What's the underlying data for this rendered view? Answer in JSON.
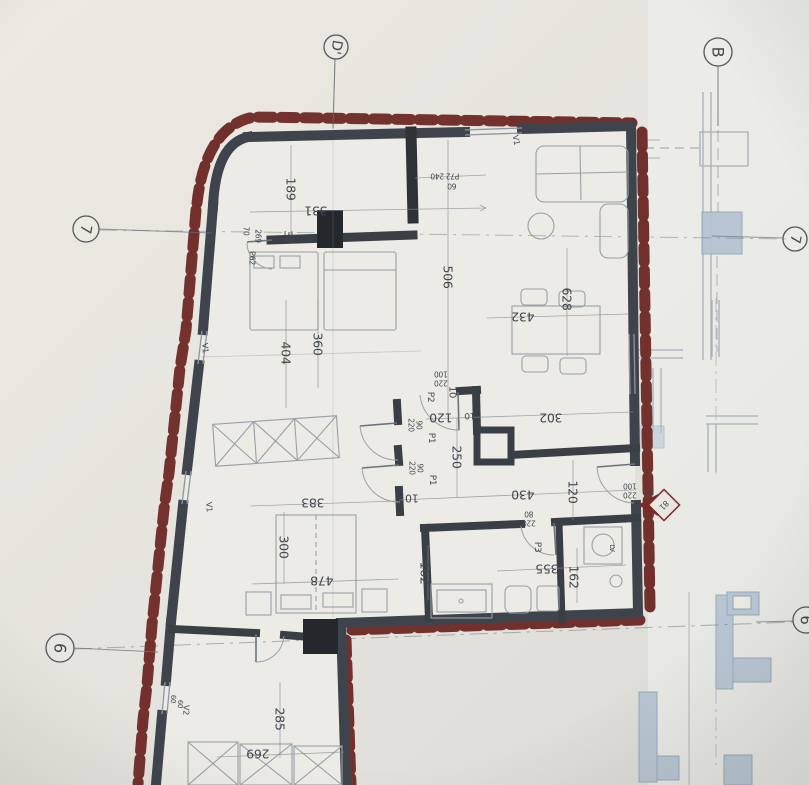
{
  "sheet": {
    "description_labels_note": "architectural floor plan photo",
    "colors": {
      "paper": "#e9e7e1",
      "insulation_red": "#6e2b27",
      "wall_dark": "#3f444c",
      "wall_black": "#24282d",
      "label_ink": "#43474d",
      "adjacent_blue": "#b3c3d2",
      "entry_marker_red": "#7c2a24"
    }
  },
  "grid_markers": [
    {
      "label": "D'",
      "cx": 336,
      "cy": 47,
      "r": 12,
      "rot": 100,
      "leader": "M335,59 L333,128"
    },
    {
      "label": "B",
      "cx": 718,
      "cy": 52,
      "r": 14,
      "rot": 90,
      "leader": "M718,66 L718,126"
    },
    {
      "label": "7",
      "cx": 86,
      "cy": 229,
      "r": 13,
      "rot": 100,
      "leader": "M99,229 L212,233"
    },
    {
      "label": "7",
      "cx": 795,
      "cy": 239,
      "r": 12,
      "rot": 100,
      "leader": "M712,236 L783,238"
    },
    {
      "label": "6",
      "cx": 60,
      "cy": 648,
      "r": 14,
      "rot": 95,
      "leader": "M74,648 L158,652"
    },
    {
      "label": "6",
      "cx": 806,
      "cy": 620,
      "r": 13,
      "rot": 95,
      "leader": "M756,622 L793,621"
    }
  ],
  "labels": [
    {
      "text": "189",
      "x": 291,
      "y": 189,
      "rot": 90,
      "size": 12.5
    },
    {
      "text": "331",
      "x": 316,
      "y": 211,
      "rot": 180,
      "size": 12.5
    },
    {
      "text": "37",
      "x": 288,
      "y": 237,
      "rot": 90,
      "size": 11
    },
    {
      "text": "P62",
      "x": 252,
      "y": 258,
      "rot": 90,
      "size": 8
    },
    {
      "text": "70",
      "x": 246,
      "y": 231,
      "rot": 90,
      "size": 7.5
    },
    {
      "text": "269",
      "x": 258,
      "y": 236,
      "rot": 90,
      "size": 7.5
    },
    {
      "text": "P72 240",
      "x": 445,
      "y": 176,
      "rot": 180,
      "size": 7.5
    },
    {
      "text": "60",
      "x": 452,
      "y": 186,
      "rot": 180,
      "size": 7.5
    },
    {
      "text": "V1",
      "x": 516,
      "y": 140,
      "rot": 80,
      "size": 8
    },
    {
      "text": "506",
      "x": 448,
      "y": 277,
      "rot": 90,
      "size": 12.5
    },
    {
      "text": "628",
      "x": 567,
      "y": 299,
      "rot": 90,
      "size": 12.5
    },
    {
      "text": "432",
      "x": 523,
      "y": 317,
      "rot": 180,
      "size": 12.5
    },
    {
      "text": "404",
      "x": 286,
      "y": 353,
      "rot": 90,
      "size": 12.5
    },
    {
      "text": "360",
      "x": 318,
      "y": 344,
      "rot": 90,
      "size": 12.5
    },
    {
      "text": "V1",
      "x": 205,
      "y": 348,
      "rot": 85,
      "size": 8
    },
    {
      "text": "100",
      "x": 441,
      "y": 374,
      "rot": 180,
      "size": 7.5
    },
    {
      "text": "220",
      "x": 441,
      "y": 383,
      "rot": 180,
      "size": 7.5
    },
    {
      "text": "P2",
      "x": 430,
      "y": 397,
      "rot": 90,
      "size": 9
    },
    {
      "text": "10",
      "x": 452,
      "y": 392,
      "rot": 90,
      "size": 10
    },
    {
      "text": "120",
      "x": 441,
      "y": 418,
      "rot": 180,
      "size": 12.5
    },
    {
      "text": "10",
      "x": 470,
      "y": 415,
      "rot": 180,
      "size": 9
    },
    {
      "text": "302",
      "x": 551,
      "y": 418,
      "rot": 180,
      "size": 12.5
    },
    {
      "text": "220",
      "x": 411,
      "y": 425,
      "rot": 90,
      "size": 7.5
    },
    {
      "text": "90",
      "x": 419,
      "y": 425,
      "rot": 90,
      "size": 7.5
    },
    {
      "text": "P1",
      "x": 431,
      "y": 438,
      "rot": 90,
      "size": 9
    },
    {
      "text": "220",
      "x": 412,
      "y": 468,
      "rot": 90,
      "size": 7.5
    },
    {
      "text": "90",
      "x": 420,
      "y": 468,
      "rot": 90,
      "size": 7.5
    },
    {
      "text": "P1",
      "x": 432,
      "y": 480,
      "rot": 90,
      "size": 9
    },
    {
      "text": "250",
      "x": 457,
      "y": 457,
      "rot": 90,
      "size": 12.5
    },
    {
      "text": "10",
      "x": 412,
      "y": 498,
      "rot": 180,
      "size": 11
    },
    {
      "text": "430",
      "x": 523,
      "y": 495,
      "rot": 180,
      "size": 12.5
    },
    {
      "text": "120",
      "x": 573,
      "y": 492,
      "rot": 90,
      "size": 12.5
    },
    {
      "text": "383",
      "x": 313,
      "y": 503,
      "rot": 180,
      "size": 12.5
    },
    {
      "text": "V1",
      "x": 209,
      "y": 507,
      "rot": 85,
      "size": 8
    },
    {
      "text": "300",
      "x": 284,
      "y": 547,
      "rot": 90,
      "size": 12.5
    },
    {
      "text": "478",
      "x": 322,
      "y": 581,
      "rot": 180,
      "size": 12.5
    },
    {
      "text": "162",
      "x": 425,
      "y": 573,
      "rot": 90,
      "size": 12.5
    },
    {
      "text": "80",
      "x": 529,
      "y": 514,
      "rot": 180,
      "size": 7.5
    },
    {
      "text": "220",
      "x": 529,
      "y": 523,
      "rot": 180,
      "size": 7.5
    },
    {
      "text": "P3",
      "x": 537,
      "y": 547,
      "rot": 90,
      "size": 9
    },
    {
      "text": "355",
      "x": 547,
      "y": 569,
      "rot": 180,
      "size": 12.5
    },
    {
      "text": "162",
      "x": 574,
      "y": 577,
      "rot": 90,
      "size": 12.5
    },
    {
      "text": "LV",
      "x": 612,
      "y": 548,
      "rot": 90,
      "size": 7
    },
    {
      "text": "P2",
      "x": 649,
      "y": 491,
      "rot": 180,
      "size": 9
    },
    {
      "text": "100",
      "x": 630,
      "y": 486,
      "rot": 180,
      "size": 7.5
    },
    {
      "text": "220",
      "x": 630,
      "y": 495,
      "rot": 180,
      "size": 7.5
    },
    {
      "text": "81",
      "x": 664,
      "y": 505,
      "rot": 135,
      "size": 8,
      "color": "#7c2a24"
    },
    {
      "text": "285",
      "x": 280,
      "y": 719,
      "rot": 90,
      "size": 12.5
    },
    {
      "text": "269",
      "x": 258,
      "y": 754,
      "rot": 180,
      "size": 12.5
    },
    {
      "text": "V2",
      "x": 186,
      "y": 710,
      "rot": 92,
      "size": 8
    },
    {
      "text": "60",
      "x": 173,
      "y": 699,
      "rot": 92,
      "size": 7
    },
    {
      "text": "60",
      "x": 180,
      "y": 704,
      "rot": 92,
      "size": 7
    }
  ]
}
